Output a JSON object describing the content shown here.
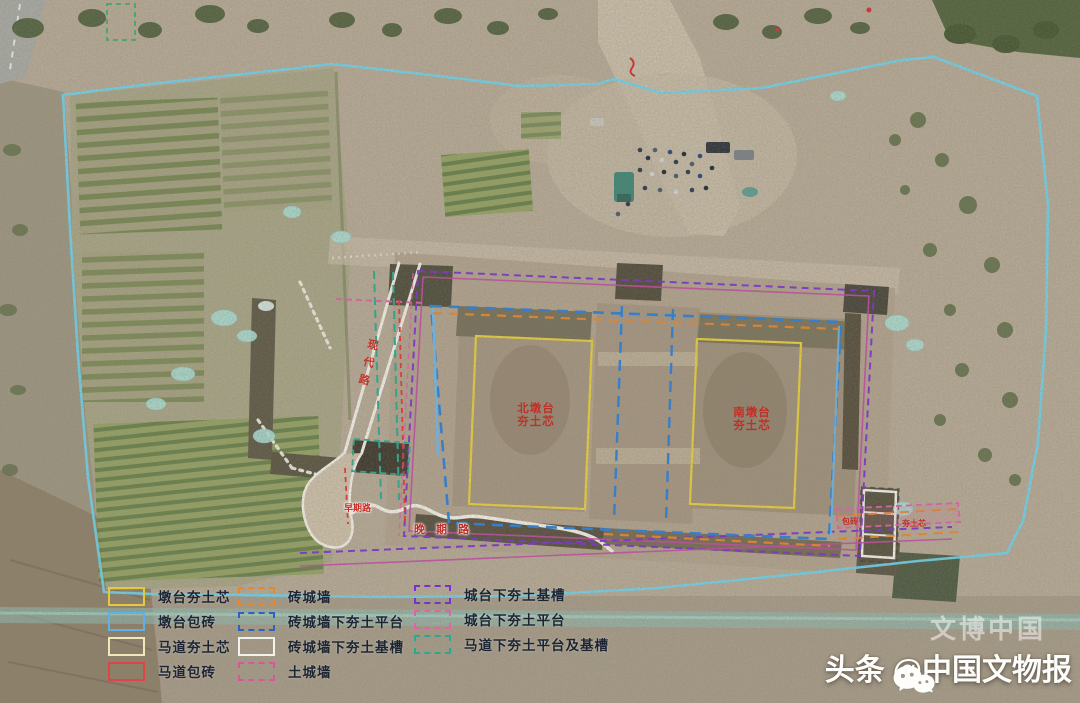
{
  "site_labels": {
    "north_pier_line1": "北墩台",
    "north_pier_line2": "夯土芯",
    "south_pier_line1": "南墩台",
    "south_pier_line2": "夯土芯",
    "diagonal_road": "现代路",
    "late_road": "晚 期 路",
    "early_road": "早期路",
    "east_label_1": "包砖",
    "east_label_2": "夯土芯"
  },
  "legend": {
    "columns": [
      {
        "items": [
          {
            "label": "墩台夯土芯",
            "color": "#e3c93c",
            "style": "solid"
          },
          {
            "label": "墩台包砖",
            "color": "#5fb0e8",
            "style": "solid"
          },
          {
            "label": "马道夯土芯",
            "color": "#eee8bc",
            "style": "solid"
          },
          {
            "label": "马道包砖",
            "color": "#e04545",
            "style": "solid"
          }
        ]
      },
      {
        "items": [
          {
            "label": "砖城墙",
            "color": "#e8872a",
            "style": "dashed"
          },
          {
            "label": "砖城墙下夯土平台",
            "color": "#2b62c4",
            "style": "dashed"
          },
          {
            "label": "砖城墙下夯土基槽",
            "color": "#f2f2ec",
            "style": "solid"
          },
          {
            "label": "土城墙",
            "color": "#d9569e",
            "style": "dashed"
          }
        ]
      },
      {
        "items": [
          {
            "label": "城台下夯土基槽",
            "color": "#7a2fd0",
            "style": "dashed"
          },
          {
            "label": "城台下夯土平台",
            "color": "#db64ac",
            "style": "dashed"
          },
          {
            "label": "马道下夯土平台及基槽",
            "color": "#2aa98f",
            "style": "dashed"
          }
        ]
      }
    ]
  },
  "watermark": {
    "faint_text": "文博中国",
    "prefix": "头条",
    "at_name": "@中国文物报",
    "icon": "wechat-icon"
  },
  "overlay_colors": {
    "boundary": "#6fd2ea",
    "purple_trench": "#7a2fd0",
    "magenta_wall": "#c24aa4",
    "blue_platform": "#2b7fd4",
    "orange_brick": "#e8872a",
    "yellow_core": "#e8cf3a",
    "green_ramp": "#2aa98f",
    "red_brick": "#e23535",
    "red_text": "#c22a22"
  }
}
